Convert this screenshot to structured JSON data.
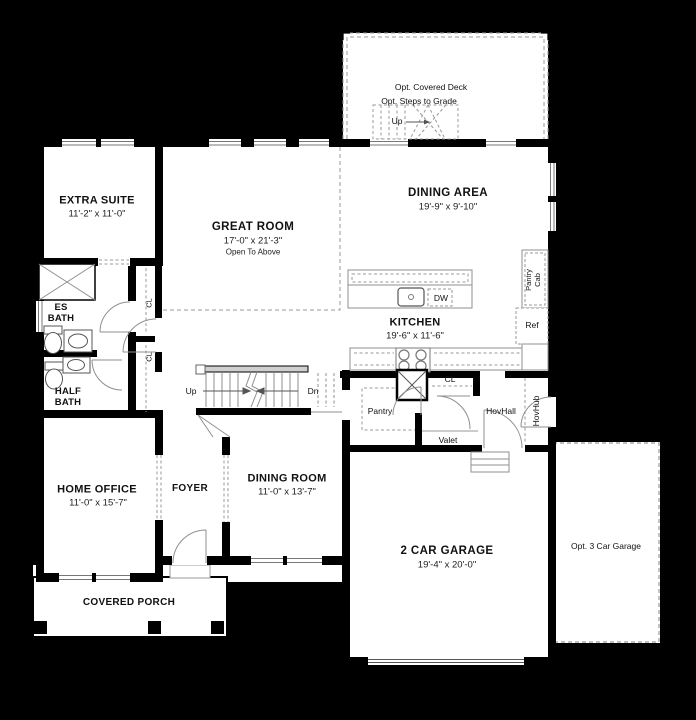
{
  "title": "First floor plan",
  "colors": {
    "background": "#000000",
    "floor": "#ffffff",
    "wall": "#000000",
    "line": "#8f8f8f"
  },
  "rooms": {
    "extra_suite": {
      "name": "EXTRA SUITE",
      "dims": "11'-2\" x 11'-0\""
    },
    "great_room": {
      "name": "GREAT ROOM",
      "dims": "17'-0\" x 21'-3\"",
      "note": "Open To Above"
    },
    "dining_area": {
      "name": "DINING AREA",
      "dims": "19'-9\" x 9'-10\""
    },
    "kitchen": {
      "name": "KITCHEN",
      "dims": "19'-6\" x 11'-6\""
    },
    "es_bath": {
      "name": "ES\nBATH"
    },
    "half_bath": {
      "name": "HALF\nBATH"
    },
    "home_office": {
      "name": "HOME OFFICE",
      "dims": "11'-0\" x 15'-7\""
    },
    "foyer": {
      "name": "FOYER"
    },
    "dining_room": {
      "name": "DINING ROOM",
      "dims": "11'-0\" x 13'-7\""
    },
    "garage": {
      "name": "2 CAR GARAGE",
      "dims": "19'-4\" x 20'-0\""
    },
    "covered_porch": {
      "name": "COVERED PORCH"
    },
    "opt_garage": {
      "name": "Opt. 3 Car Garage"
    },
    "deck": {
      "name": "Opt. Covered Deck",
      "steps": "Opt. Steps to Grade"
    }
  },
  "annotations": {
    "up_deck": "Up",
    "up_main": "Up",
    "dn_main": "Dn",
    "pantry": "Pantry",
    "valet": "Valet",
    "hovhall": "HovHall",
    "hovhub": "HovHub",
    "pantry_cab": "Pantry\nCab",
    "ref": "Ref",
    "dw": "DW",
    "cl_kitchen": "CL",
    "cl_closet_upper": "CL",
    "cl_closet_lower": "CL"
  }
}
